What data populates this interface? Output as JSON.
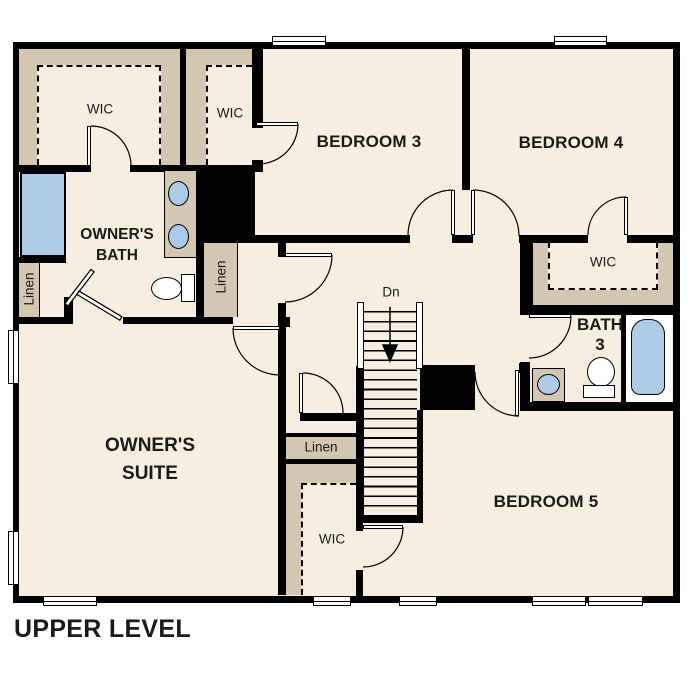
{
  "level_label": "UPPER LEVEL",
  "rooms": {
    "wic_owners": "WIC",
    "wic_upper": "WIC",
    "bedroom3": "BEDROOM 3",
    "bedroom4": "BEDROOM 4",
    "bedroom5": "BEDROOM 5",
    "wic_right": "WIC",
    "wic_lower": "WIC",
    "owners_bath_line1": "OWNER'S",
    "owners_bath_line2": "BATH",
    "owners_suite_line1": "OWNER'S",
    "owners_suite_line2": "SUITE",
    "bath3_line1": "BATH",
    "bath3_line2": "3",
    "linen_left": "Linen",
    "linen_mid": "Linen",
    "linen_center": "Linen"
  },
  "stairs": {
    "direction_label": "Dn"
  },
  "icons": {
    "fixtures": [
      "shower",
      "vanity-sink",
      "toilet",
      "bathtub",
      "stairs-down-arrow"
    ]
  },
  "colors": {
    "floor": "#f5eee1",
    "closet_shading": "#d3c7b2",
    "wall": "#000000",
    "fixture_blue": "#adcbe9",
    "background": "#ffffff"
  }
}
